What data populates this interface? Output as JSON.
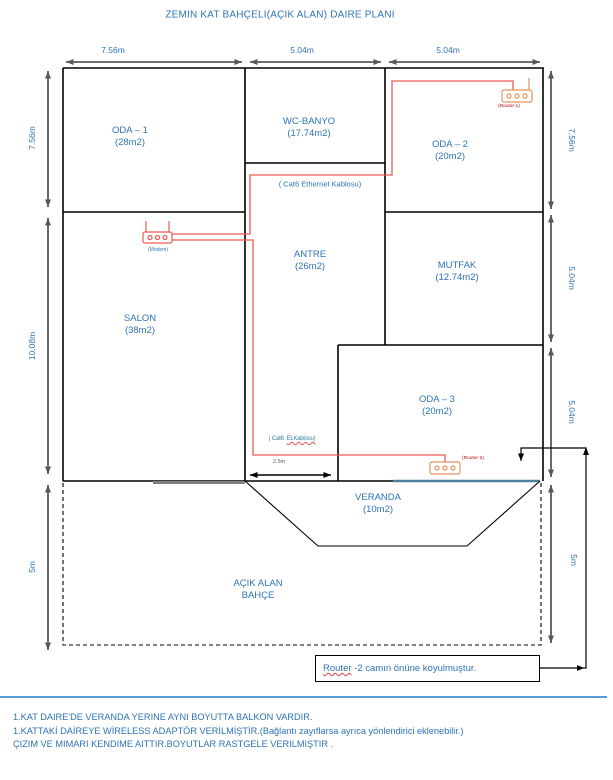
{
  "title": "ZEMIN KAT BAHÇELI(AÇIK ALAN) DAIRE PLANI",
  "rooms": [
    {
      "name": "ODA – 1",
      "area": "(28m2)"
    },
    {
      "name": "WC-BANYO",
      "area": "(17.74m2)"
    },
    {
      "name": "ODA – 2",
      "area": "(20m2)"
    },
    {
      "name": "ANTRE",
      "area": "(26m2)"
    },
    {
      "name": "MUTFAK",
      "area": "(12.74m2)"
    },
    {
      "name": "SALON",
      "area": "(38m2)"
    },
    {
      "name": "ODA – 3",
      "area": "(20m2)"
    },
    {
      "name": "VERANDA",
      "area": "(10m2)"
    },
    {
      "name": "AÇIK ALAN",
      "area": "BAHÇE"
    }
  ],
  "dimensions": {
    "top": [
      "7.56m",
      "5.04m",
      "5.04m"
    ],
    "left": [
      "7.56m",
      "10.08m",
      "5m"
    ],
    "right": [
      "7.56m",
      "5.04m",
      "5.04m",
      "5m"
    ],
    "cable_run": "2.5m"
  },
  "devices": {
    "modem_label": "(Modem)",
    "router1_label": "(Router-1)",
    "router2_label": "(Router-2)"
  },
  "cables": {
    "label_top": "( Cat6 Ethernet Kablosu)",
    "label_bottom_1": "( Cat6",
    "label_bottom_2": "Et.Kablosu)"
  },
  "note_box": {
    "prefix": "Router",
    "rest": " -2 camın önüne koyulmuştur."
  },
  "footer": {
    "line1": "1.KAT DAIRE'DE VERANDA YERINE AYNI BOYUTTA BALKON VARDIR.",
    "line2": "1.KATTAKİ DAİREYE WİRELESS ADAPTÖR VERİLMİŞTİR.(Bağlantı zayıflarsa ayrıca yönlendirici eklenebilir.)",
    "line3": "ÇIZIM VE MIMARI KENDIME AITTIR.BOYUTLAR  RASTGELE VERILMIŞTIR ."
  },
  "colors": {
    "text_blue": "#2E74B5",
    "cable_red": "#EE5A52",
    "device_orange": "#E2945F",
    "label_red": "#C00000",
    "window_blue": "#4E81A0",
    "teal": "#31859C",
    "rule_blue": "#5B9BD5",
    "dimension_gray": "#595959"
  }
}
